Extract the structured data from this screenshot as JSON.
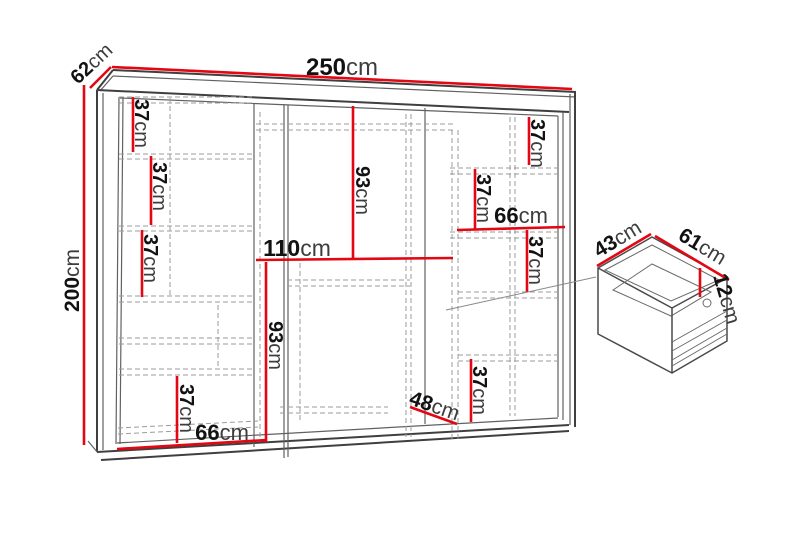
{
  "diagram": {
    "type": "wardrobe-dimension-diagram",
    "unit": "cm",
    "colors": {
      "dimension_red": "#e30613",
      "outline_gray": "#3f3f3f",
      "dashed_gray": "#9b9b9b",
      "background": "#ffffff"
    }
  },
  "labels": {
    "width_250": {
      "n": "250",
      "u": "cm"
    },
    "depth_62": {
      "n": "62",
      "u": "cm"
    },
    "height_200": {
      "n": "200",
      "u": "cm"
    },
    "left_37_1": {
      "n": "37",
      "u": "cm"
    },
    "left_37_2": {
      "n": "37",
      "u": "cm"
    },
    "left_37_3": {
      "n": "37",
      "u": "cm"
    },
    "left_37_4": {
      "n": "37",
      "u": "cm"
    },
    "left_66": {
      "n": "66",
      "u": "cm"
    },
    "mid_93_top": {
      "n": "93",
      "u": "cm"
    },
    "mid_110": {
      "n": "110",
      "u": "cm"
    },
    "mid_93_bot": {
      "n": "93",
      "u": "cm"
    },
    "mid_48": {
      "n": "48",
      "u": "cm"
    },
    "right_37_1": {
      "n": "37",
      "u": "cm"
    },
    "right_37_2": {
      "n": "37",
      "u": "cm"
    },
    "right_66": {
      "n": "66",
      "u": "cm"
    },
    "right_37_3": {
      "n": "37",
      "u": "cm"
    },
    "right_37_4": {
      "n": "37",
      "u": "cm"
    },
    "drawer_43": {
      "n": "43",
      "u": "cm"
    },
    "drawer_61": {
      "n": "61",
      "u": "cm"
    },
    "drawer_12": {
      "n": "12",
      "u": "cm"
    }
  }
}
